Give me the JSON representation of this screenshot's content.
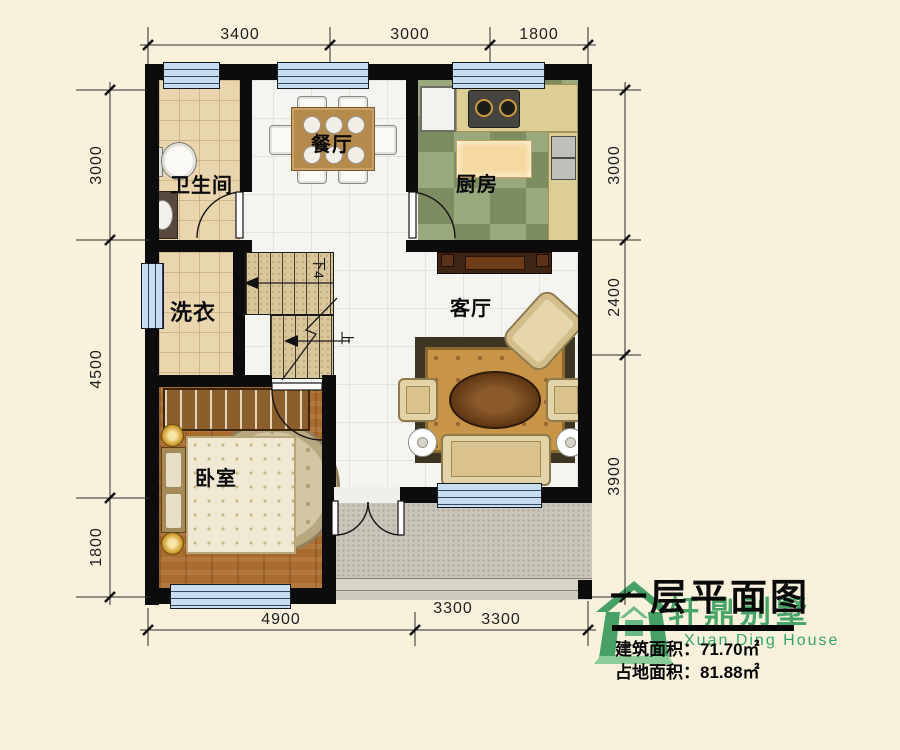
{
  "plan": {
    "rooms": [
      {
        "id": "bathroom",
        "label": "卫生间"
      },
      {
        "id": "dining",
        "label": "餐厅"
      },
      {
        "id": "kitchen",
        "label": "厨房"
      },
      {
        "id": "laundry",
        "label": "洗衣"
      },
      {
        "id": "living",
        "label": "客厅"
      },
      {
        "id": "bedroom",
        "label": "卧室"
      }
    ],
    "stairs": {
      "down_label": "下4",
      "up_label": "上"
    }
  },
  "dimensions": {
    "top": [
      "3400",
      "3000",
      "1800"
    ],
    "left": [
      "3000",
      "4500",
      "1800"
    ],
    "right": [
      "3000",
      "2400",
      "3900"
    ],
    "bottom": [
      "4900",
      "3300"
    ],
    "bottom_partial": "3300"
  },
  "title_block": {
    "title": "一层平面图",
    "brand": "轩鼎别墅",
    "brand_en": "Xuan Ding House",
    "building_area": "建筑面积：71.70㎡",
    "footprint_area": "占地面积：81.88㎡"
  },
  "colors": {
    "background": "#F8F1DC",
    "wall": "#0C0C0C",
    "window": "#C8DCF2",
    "brand_green": "#2FA66B",
    "bathroom_tile": "#E9D6AF",
    "kitchen_green": "#7E8C62",
    "bedroom_wood": "#A96B2E",
    "terrace_gray": "#CBC6BC"
  }
}
